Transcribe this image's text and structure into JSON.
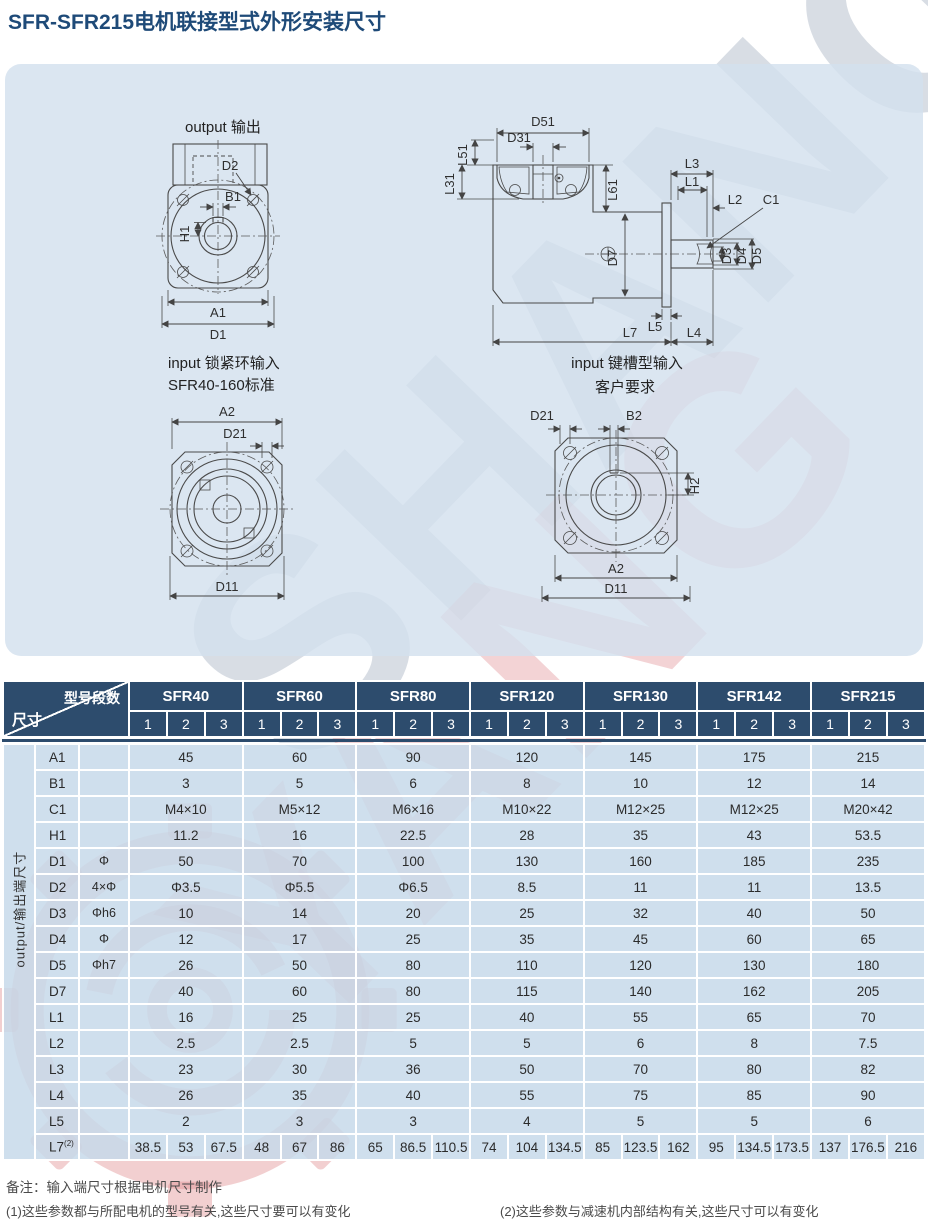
{
  "page": {
    "title": "SFR-SFR215电机联接型式外形安装尺寸"
  },
  "watermark": {
    "text_top": "SHANG",
    "text_bottom": "YANG"
  },
  "drawings": {
    "output_front": {
      "title": "output 输出",
      "d2": "D2",
      "b1": "B1",
      "h1": "H1",
      "a1": "A1",
      "d1": "D1"
    },
    "side_section": {
      "d51": "D51",
      "d31": "D31",
      "l51": "L51",
      "l31": "L31",
      "l61": "L61",
      "l3": "L3",
      "l1": "L1",
      "l2": "L2",
      "c1": "C1",
      "d7": "D7",
      "d3": "D3",
      "d4": "D4",
      "d5": "D5",
      "l5": "L5",
      "l7": "L7",
      "l4": "L4"
    },
    "input_clamp": {
      "title_line1": "input 锁紧环输入",
      "title_line2": "SFR40-160标准",
      "a2": "A2",
      "d21": "D21",
      "d11": "D11"
    },
    "input_keyway": {
      "title_line1": "input 键槽型输入",
      "title_line2": "客户要求",
      "d21": "D21",
      "b2": "B2",
      "h2": "H2",
      "a2": "A2",
      "d11": "D11"
    }
  },
  "table": {
    "corner_top": "型号段数",
    "corner_bottom": "尺寸",
    "models": [
      "SFR40",
      "SFR60",
      "SFR80",
      "SFR120",
      "SFR130",
      "SFR142",
      "SFR215"
    ],
    "sub_cols": [
      "1",
      "2",
      "3"
    ],
    "side_label": "output/输出端尺寸",
    "rows": [
      {
        "param": "A1",
        "symbol": "",
        "values": [
          "45",
          "60",
          "90",
          "120",
          "145",
          "175",
          "215"
        ]
      },
      {
        "param": "B1",
        "symbol": "",
        "values": [
          "3",
          "5",
          "6",
          "8",
          "10",
          "12",
          "14"
        ]
      },
      {
        "param": "C1",
        "symbol": "",
        "values": [
          "M4×10",
          "M5×12",
          "M6×16",
          "M10×22",
          "M12×25",
          "M12×25",
          "M20×42"
        ]
      },
      {
        "param": "H1",
        "symbol": "",
        "values": [
          "11.2",
          "16",
          "22.5",
          "28",
          "35",
          "43",
          "53.5"
        ]
      },
      {
        "param": "D1",
        "symbol": "Φ",
        "values": [
          "50",
          "70",
          "100",
          "130",
          "160",
          "185",
          "235"
        ]
      },
      {
        "param": "D2",
        "symbol": "4×Φ",
        "values": [
          "Φ3.5",
          "Φ5.5",
          "Φ6.5",
          "8.5",
          "11",
          "11",
          "13.5"
        ]
      },
      {
        "param": "D3",
        "symbol": "Φh6",
        "values": [
          "10",
          "14",
          "20",
          "25",
          "32",
          "40",
          "50"
        ]
      },
      {
        "param": "D4",
        "symbol": "Φ",
        "values": [
          "12",
          "17",
          "25",
          "35",
          "45",
          "60",
          "65"
        ]
      },
      {
        "param": "D5",
        "symbol": "Φh7",
        "values": [
          "26",
          "50",
          "80",
          "110",
          "120",
          "130",
          "180"
        ]
      },
      {
        "param": "D7",
        "symbol": "",
        "values": [
          "40",
          "60",
          "80",
          "115",
          "140",
          "162",
          "205"
        ]
      },
      {
        "param": "L1",
        "symbol": "",
        "values": [
          "16",
          "25",
          "25",
          "40",
          "55",
          "65",
          "70"
        ]
      },
      {
        "param": "L2",
        "symbol": "",
        "values": [
          "2.5",
          "2.5",
          "5",
          "5",
          "6",
          "8",
          "7.5"
        ]
      },
      {
        "param": "L3",
        "symbol": "",
        "values": [
          "23",
          "30",
          "36",
          "50",
          "70",
          "80",
          "82"
        ]
      },
      {
        "param": "L4",
        "symbol": "",
        "values": [
          "26",
          "35",
          "40",
          "55",
          "75",
          "85",
          "90"
        ]
      },
      {
        "param": "L5",
        "symbol": "",
        "values": [
          "2",
          "3",
          "3",
          "4",
          "5",
          "5",
          "6"
        ]
      },
      {
        "param": "L7",
        "sup": "(2)",
        "symbol": "",
        "values_per_col": [
          [
            "38.5",
            "53",
            "67.5"
          ],
          [
            "48",
            "67",
            "86"
          ],
          [
            "65",
            "86.5",
            "110.5"
          ],
          [
            "74",
            "104",
            "134.5"
          ],
          [
            "85",
            "123.5",
            "162"
          ],
          [
            "95",
            "134.5",
            "173.5"
          ],
          [
            "137",
            "176.5",
            "216"
          ]
        ]
      }
    ]
  },
  "footer": {
    "note": "备注：输入端尺寸根据电机尺寸制作",
    "note1": "(1)这些参数都与所配电机的型号有关,这些尺寸要可以有变化",
    "note2": "(2)这些参数与减速机内部结构有关,这些尺寸可以有变化"
  },
  "colors": {
    "header_bg": "#2d4c6d",
    "panel_bg": "#d3e1ee",
    "cell_bg": "#c7d9ea",
    "title": "#1e4a78",
    "watermark_pink": "#e08c90",
    "watermark_gray": "#9eabbc"
  }
}
